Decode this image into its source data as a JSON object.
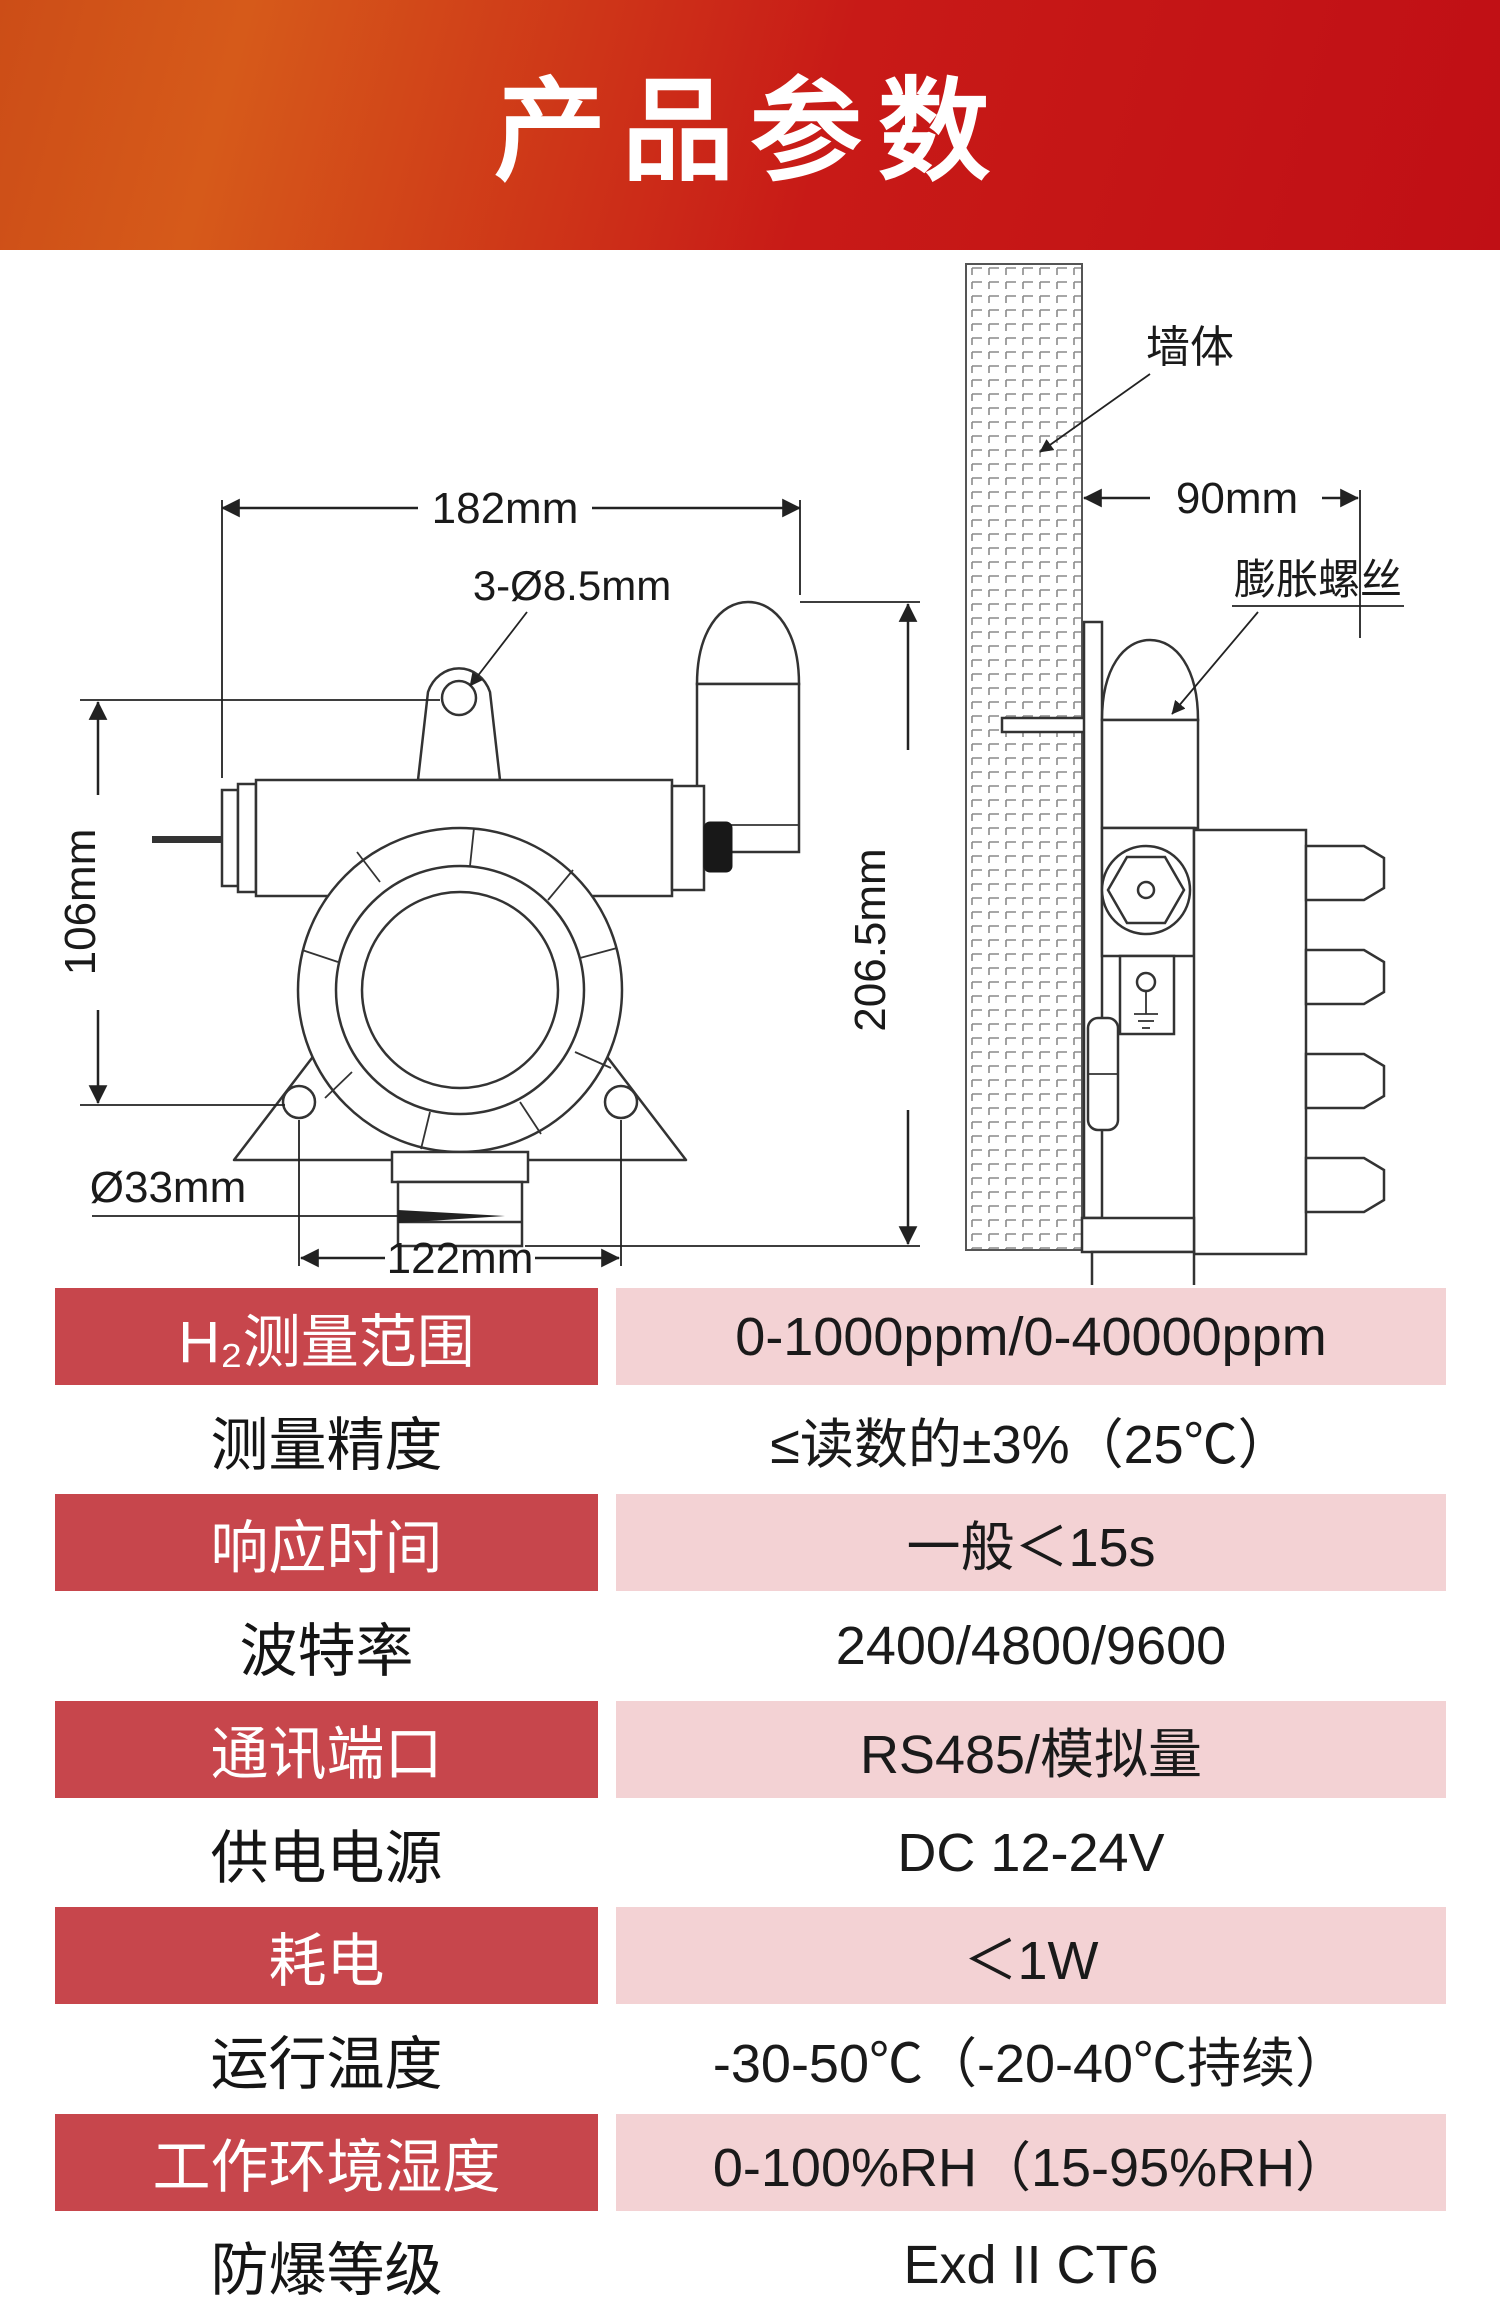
{
  "header": {
    "title": "产品参数"
  },
  "diagram": {
    "front": {
      "width_label": "182mm",
      "holes_label": "3-Ø8.5mm",
      "height_label": "106mm",
      "total_height_label": "206.5mm",
      "probe_diameter_label": "Ø33mm",
      "hole_spacing_label": "122mm"
    },
    "side": {
      "wall_label": "墙体",
      "depth_label": "90mm",
      "anchor_label": "膨胀螺丝"
    }
  },
  "table": {
    "rows": [
      {
        "label": "H₂测量范围",
        "value": "0-1000ppm/0-40000ppm"
      },
      {
        "label": "测量精度",
        "value": "≤读数的±3%（25℃）"
      },
      {
        "label": "响应时间",
        "value": "一般＜15s"
      },
      {
        "label": "波特率",
        "value": "2400/4800/9600"
      },
      {
        "label": "通讯端口",
        "value": "RS485/模拟量"
      },
      {
        "label": "供电电源",
        "value": "DC 12-24V"
      },
      {
        "label": "耗电",
        "value": "＜1W"
      },
      {
        "label": "运行温度",
        "value": "-30-50℃（-20-40℃持续）"
      },
      {
        "label": "工作环境湿度",
        "value": "0-100%RH（15-95%RH）"
      },
      {
        "label": "防爆等级",
        "value": "Exd II CT6"
      }
    ]
  },
  "colors": {
    "header_gradient_start": "#cc4d17",
    "header_gradient_end": "#c00f15",
    "row_label_bg": "#c7464c",
    "row_value_bg": "#f3d2d4"
  }
}
